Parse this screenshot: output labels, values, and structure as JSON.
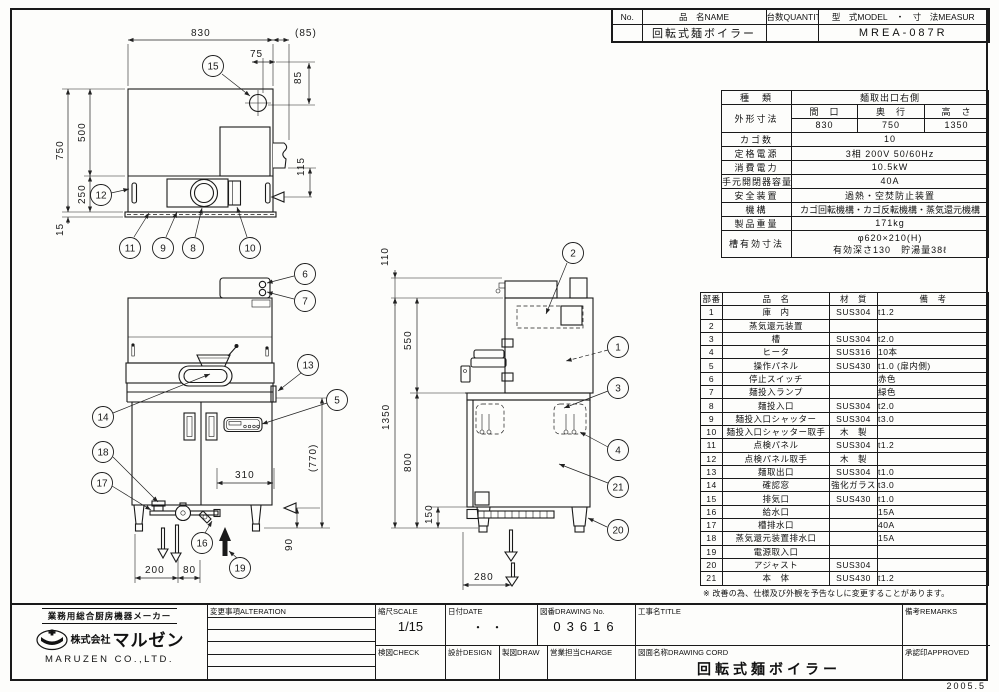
{
  "page": {
    "date_stamp": "2005.5"
  },
  "header_table": {
    "no_label": "No.",
    "name_label": "品　名NAME",
    "qty_label": "台数QUANTITY",
    "model_label": "型　式MODEL　・　寸　法MEASUR",
    "no_value": "",
    "name_value": "回転式麺ボイラー",
    "qty_value": "",
    "model_value": "MREA-087R"
  },
  "spec_table": {
    "kind_label": "種　類",
    "kind_value": "麺取出口右側",
    "outer_dim_label": "外形寸法",
    "width_label": "間　口",
    "depth_label": "奥　行",
    "height_label": "高　さ",
    "width_value": "830",
    "depth_value": "750",
    "height_value": "1350",
    "basket_label": "カゴ数",
    "basket_value": "10",
    "power_label": "定格電源",
    "power_value": "3相 200V 50/60Hz",
    "consumption_label": "消費電力",
    "consumption_value": "10.5kW",
    "breaker_label": "手元開閉器容量",
    "breaker_value": "40A",
    "safety_label": "安全装置",
    "safety_value": "過熱・空焚防止装置",
    "mechanism_label": "機構",
    "mechanism_value": "カゴ回転機構・カゴ反転機構・蒸気還元機構",
    "weight_label": "製品重量",
    "weight_value": "171kg",
    "tank_label": "槽有効寸法",
    "tank_value_1": "φ620×210(H)",
    "tank_value_2": "有効深さ130　貯湯量38ℓ"
  },
  "parts_table": {
    "headers": [
      "部番",
      "品　名",
      "材　質",
      "備　考"
    ],
    "rows": [
      [
        "1",
        "庫　内",
        "SUS304",
        "t1.2"
      ],
      [
        "2",
        "蒸気還元装置",
        "",
        ""
      ],
      [
        "3",
        "槽",
        "SUS304",
        "t2.0"
      ],
      [
        "4",
        "ヒータ",
        "SUS316",
        "10本"
      ],
      [
        "5",
        "操作パネル",
        "SUS430",
        "t1.0 (扉内側)"
      ],
      [
        "6",
        "停止スイッチ",
        "",
        "赤色"
      ],
      [
        "7",
        "麺投入ランプ",
        "",
        "緑色"
      ],
      [
        "8",
        "麺投入口",
        "SUS304",
        "t2.0"
      ],
      [
        "9",
        "麺投入口シャッター",
        "SUS304",
        "t3.0"
      ],
      [
        "10",
        "麺投入口シャッター取手",
        "木　製",
        ""
      ],
      [
        "11",
        "点検パネル",
        "SUS304",
        "t1.2"
      ],
      [
        "12",
        "点検パネル取手",
        "木　製",
        ""
      ],
      [
        "13",
        "麺取出口",
        "SUS304",
        "t1.0"
      ],
      [
        "14",
        "確認窓",
        "強化ガラス",
        "t3.0"
      ],
      [
        "15",
        "排気口",
        "SUS430",
        "t1.0"
      ],
      [
        "16",
        "給水口",
        "",
        "15A"
      ],
      [
        "17",
        "槽排水口",
        "",
        "40A"
      ],
      [
        "18",
        "蒸気還元装置排水口",
        "",
        "15A"
      ],
      [
        "19",
        "電源取入口",
        "",
        ""
      ],
      [
        "20",
        "アジャスト",
        "SUS304",
        ""
      ],
      [
        "21",
        "本　体",
        "SUS430",
        "t1.2"
      ]
    ],
    "note": "※ 改善の為、仕様及び外観を予告なしに変更することがあります。"
  },
  "title_block": {
    "maker_tagline": "業務用総合厨房機器メーカー",
    "company_prefix": "株式会社",
    "company_brand": "マルゼン",
    "company_en": "MARUZEN CO.,LTD.",
    "alteration_label": "変更事項ALTERATION",
    "scale_label": "縮尺SCALE",
    "scale_value": "1/15",
    "date_label": "日付DATE",
    "date_value": "・・",
    "drawing_no_label": "図番DRAWING No.",
    "drawing_no_value": "03616",
    "title_label": "工事名TITLE",
    "title_value": "",
    "remarks_label": "備考REMARKS",
    "check_label": "検図CHECK",
    "design_label": "設計DESIGN",
    "draw_label": "製図DRAW",
    "charge_label": "営業担当CHARGE",
    "drawing_name_label": "図面名称DRAWING CORD",
    "drawing_name_value": "回転式麺ボイラー",
    "approved_label": "承認印APPROVED"
  },
  "drawing": {
    "dims": {
      "plan_width": "830",
      "plan_right_offset": "(85)",
      "plan_vent_x": "75",
      "plan_vent_y": "85",
      "plan_depth_front": "500",
      "plan_depth_total": "750",
      "plan_depth_rear": "250",
      "plan_base": "15",
      "plan_right_h": "115",
      "front_door": "310",
      "front_cab_h": "(770)",
      "front_pipe_h": "90",
      "front_left": "200",
      "front_left2": "80",
      "side_top": "110",
      "side_upper": "550",
      "side_total": "1350",
      "side_lower": "800",
      "side_leg": "150",
      "side_bottom": "280"
    },
    "callouts": {
      "c1": "1",
      "c2": "2",
      "c3": "3",
      "c4": "4",
      "c5": "5",
      "c6": "6",
      "c7": "7",
      "c8": "8",
      "c9": "9",
      "c10": "10",
      "c11": "11",
      "c12": "12",
      "c13": "13",
      "c14": "14",
      "c15": "15",
      "c16": "16",
      "c17": "17",
      "c18": "18",
      "c19": "19",
      "c20": "20",
      "c21": "21"
    }
  }
}
